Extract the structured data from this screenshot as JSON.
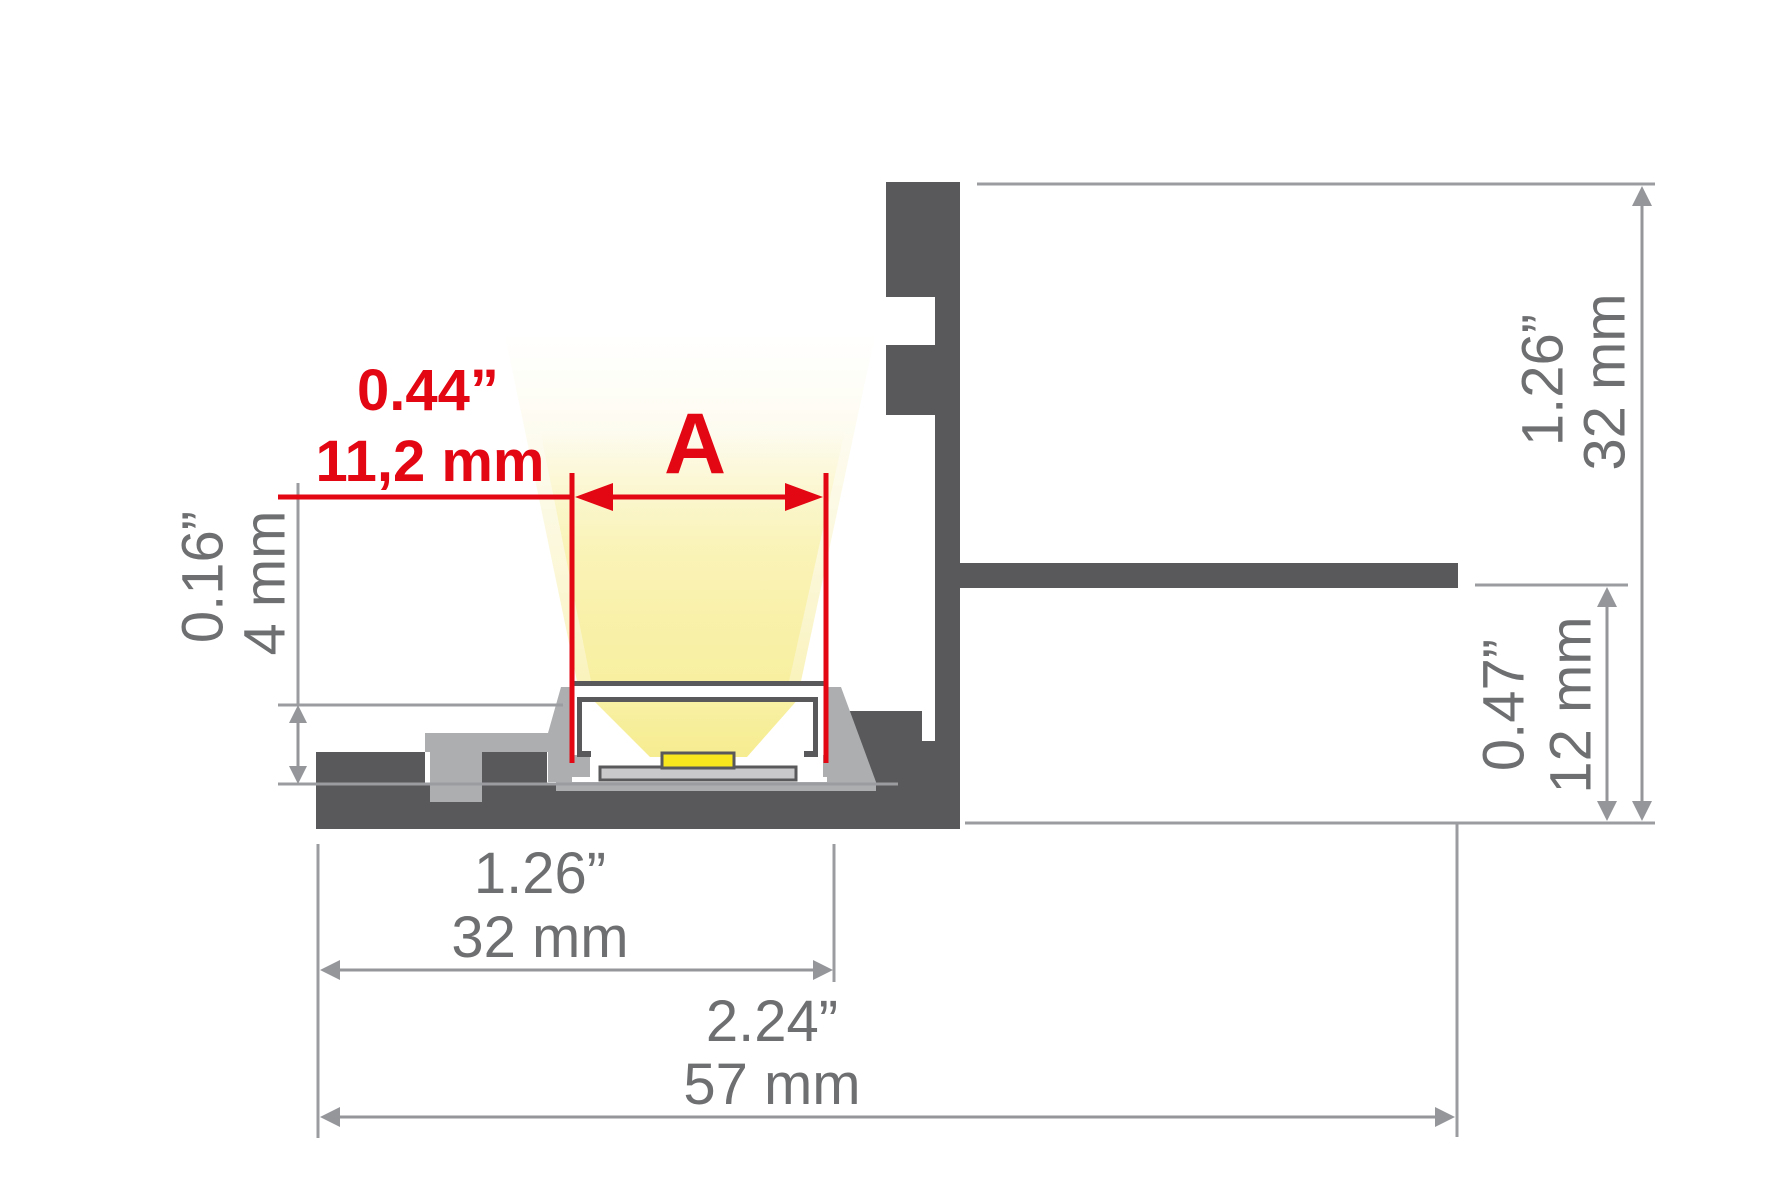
{
  "diagram": {
    "type": "led-aluminium-profile-cross-section",
    "beam_aperture": {
      "inches": "0.44”",
      "mm": "11,2 mm",
      "symbol": "A"
    },
    "recess_depth": {
      "inches": "0.16”",
      "mm": "4 mm"
    },
    "inner_width": {
      "inches": "1.26”",
      "mm": "32 mm"
    },
    "total_width": {
      "inches": "2.24”",
      "mm": "57 mm"
    },
    "profile_height": {
      "inches": "1.26”",
      "mm": "32 mm"
    },
    "flange_offset": {
      "inches": "0.47”",
      "mm": "12 mm"
    },
    "colors": {
      "dimension_red": "#e30613",
      "dimension_gray_line": "#95969a",
      "dimension_gray_text": "#6e6f71",
      "profile_dark": "#59595b",
      "profile_light": "#adaeb0",
      "pcb_gray": "#c9c9cb",
      "led_yellow": "#f8e71e",
      "beam_core_yellow": "#f8efa0",
      "beam_glow_yellow": "#fbf7dc",
      "background": "#ffffff"
    }
  }
}
